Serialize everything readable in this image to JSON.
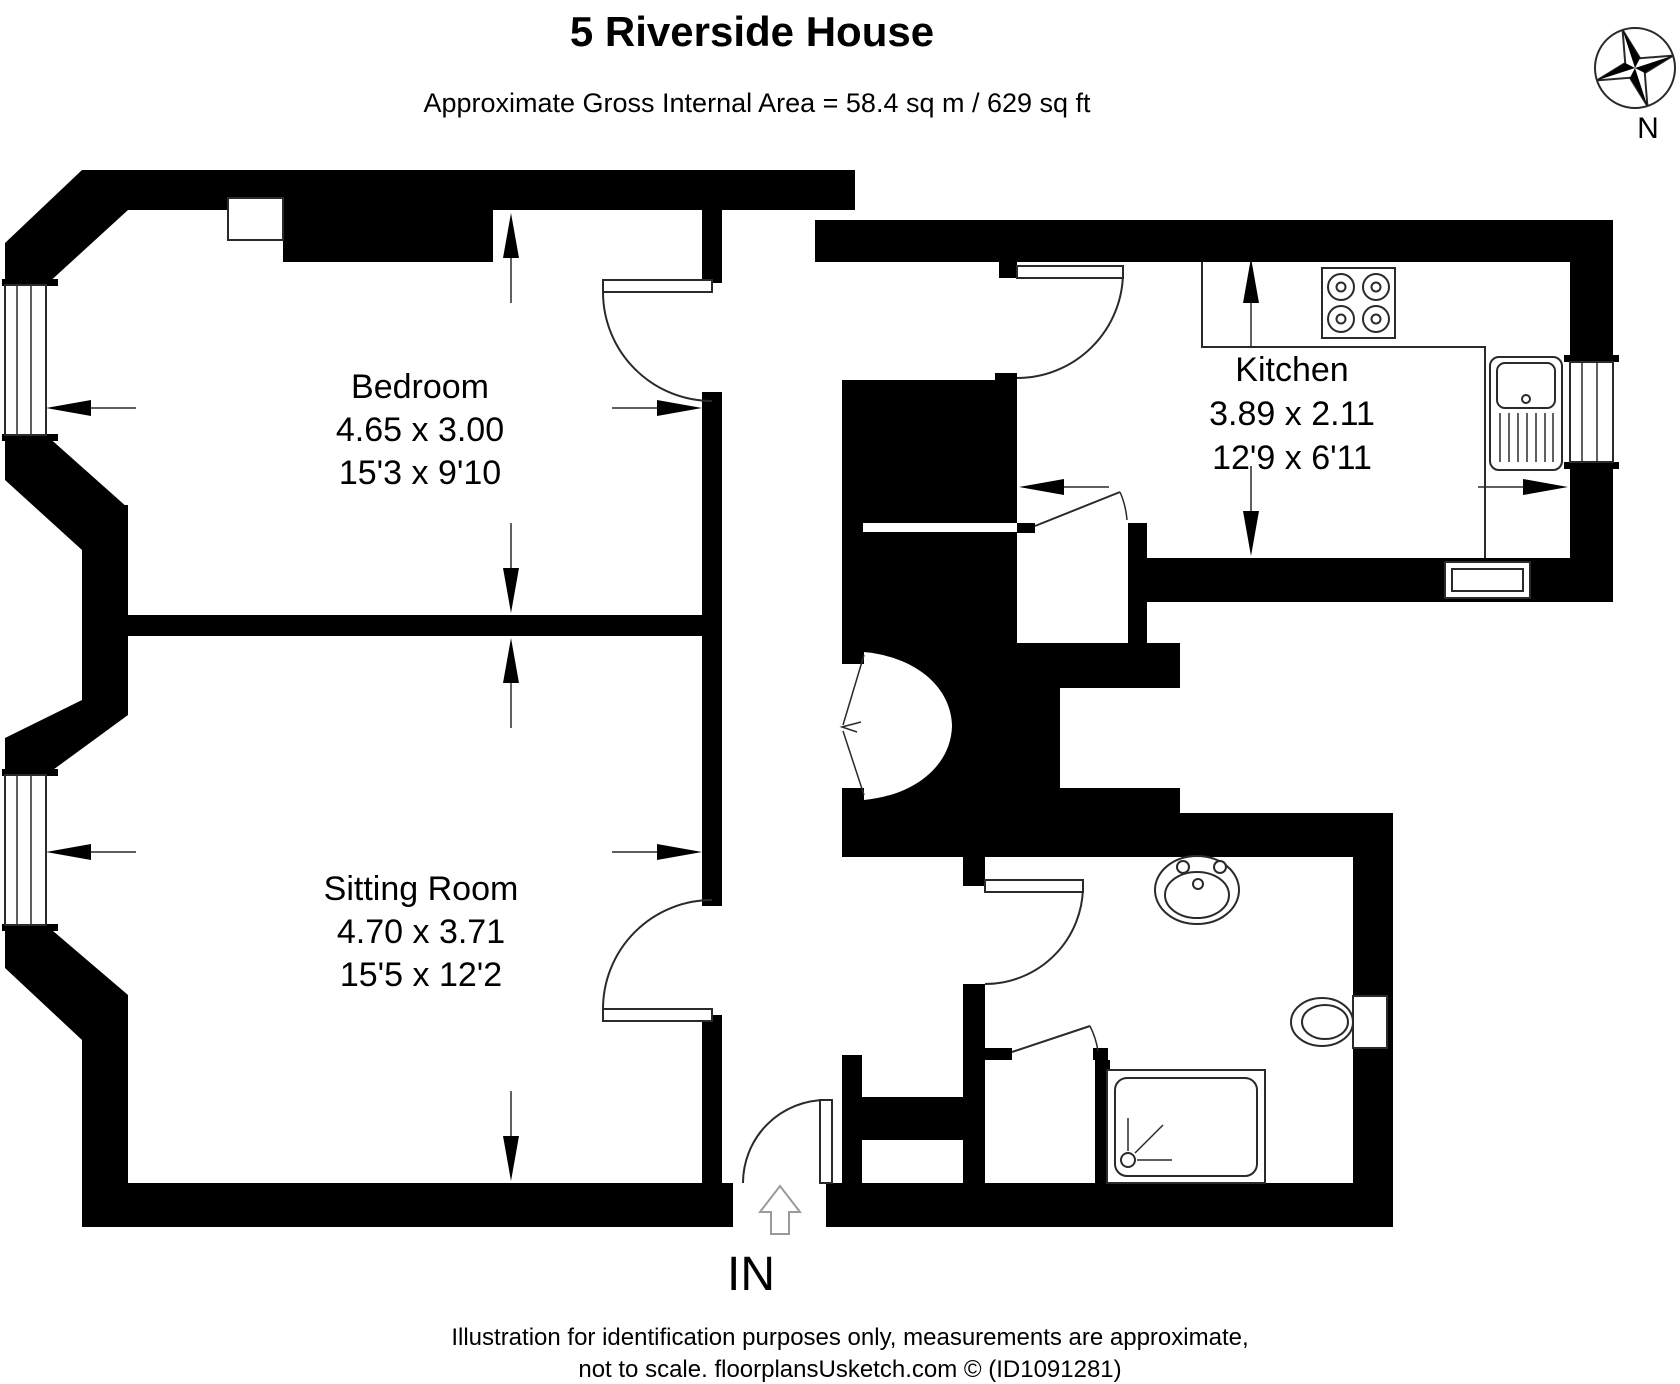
{
  "title": "5 Riverside House",
  "subtitle": "Approximate Gross Internal Area = 58.4 sq m / 629 sq ft",
  "compass": {
    "label": "N"
  },
  "rooms": {
    "bedroom": {
      "name": "Bedroom",
      "metric": "4.65 x 3.00",
      "imperial": "15'3 x 9'10"
    },
    "sitting_room": {
      "name": "Sitting Room",
      "metric": "4.70 x 3.71",
      "imperial": "15'5 x 12'2"
    },
    "kitchen": {
      "name": "Kitchen",
      "metric": "3.89 x 2.11",
      "imperial": "12'9 x 6'11"
    }
  },
  "entrance": {
    "label": "IN"
  },
  "footer": {
    "line1": "Illustration for identification purposes only, measurements are approximate,",
    "line2": "not to scale. floorplansUsketch.com © (ID1091281)"
  },
  "colors": {
    "wall": "#000000",
    "background": "#ffffff",
    "line": "#2a2a2a"
  }
}
